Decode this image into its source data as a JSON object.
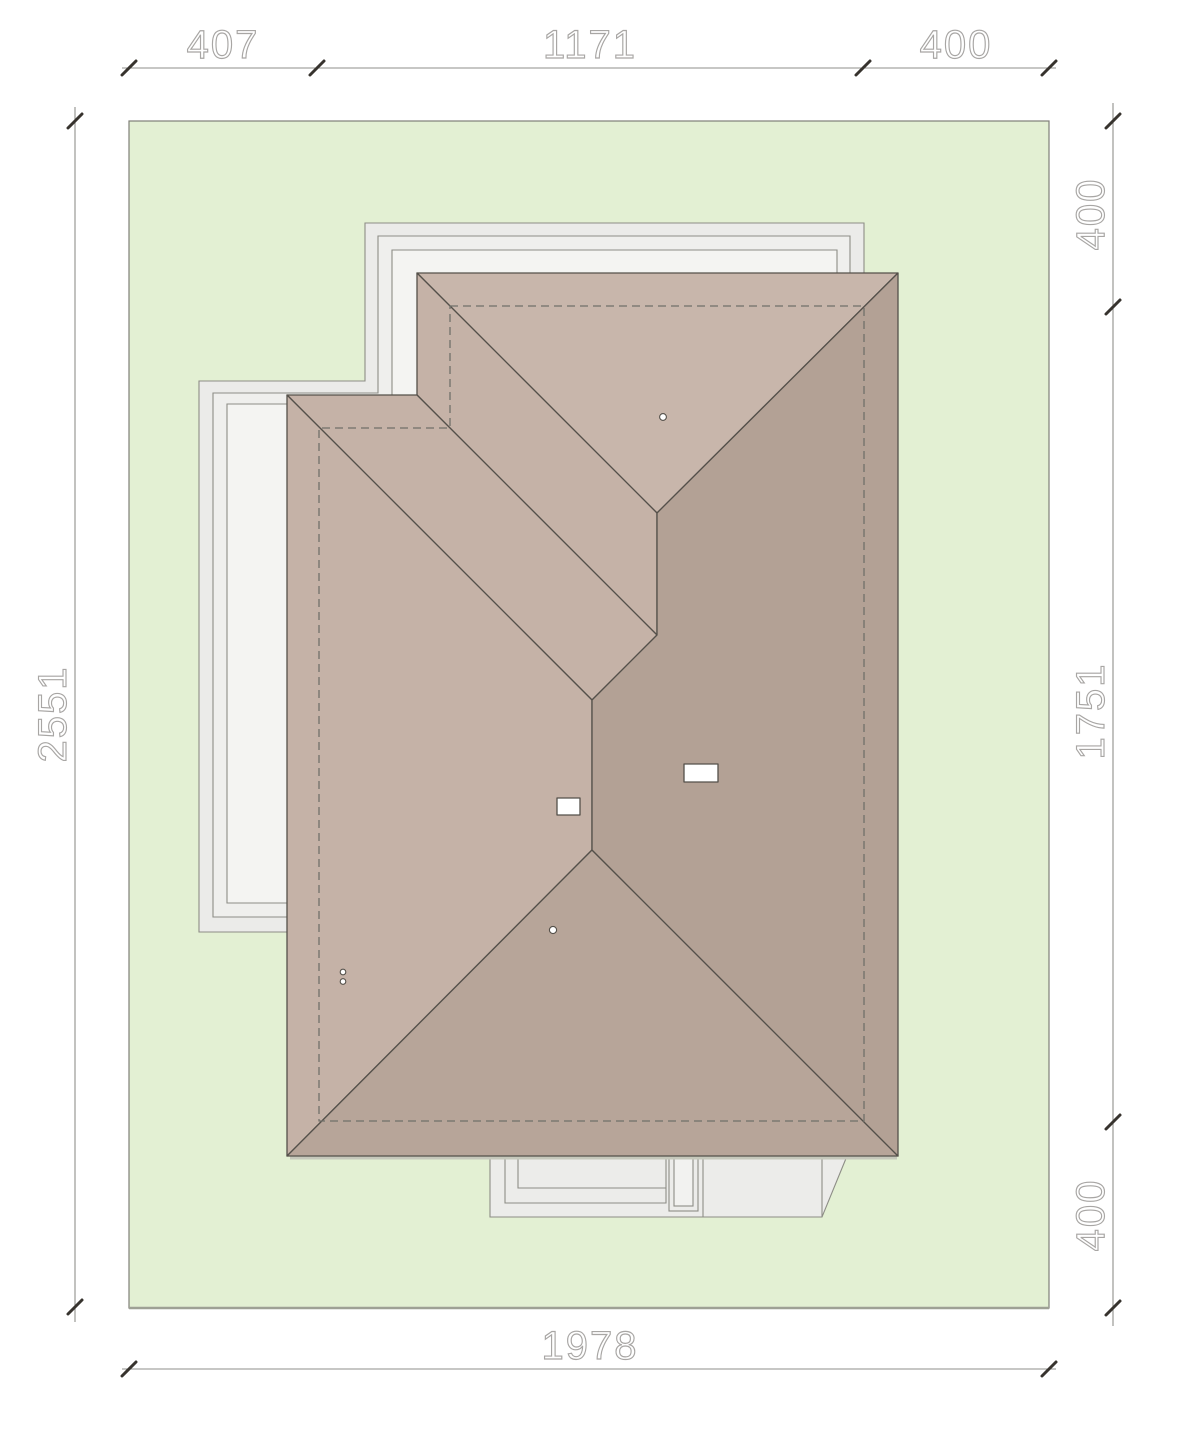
{
  "drawing": {
    "kind": "architectural roof / site plan (top view)",
    "plot_units": "cm"
  },
  "dimensions": {
    "top": {
      "segment1": "407",
      "segment2": "1171",
      "segment3": "400"
    },
    "right": {
      "segment1": "400",
      "segment2": "1751",
      "segment3": "400"
    },
    "left": {
      "total": "2551"
    },
    "bottom": {
      "total": "1978"
    }
  },
  "colors": {
    "plot_green": "#e3f0d3",
    "roof_north_slope": "#c8b6ab",
    "roof_west_slopes": "#c5b2a7",
    "roof_east_slope": "#b3a195",
    "roof_south_slope": "#b7a599",
    "roof_edge_line": "#54504a",
    "wall_dashed_line": "#70706a",
    "paving_fill": "#ededeb",
    "paving_stroke": "#8d8d86",
    "dimension_line": "#8f8f8b",
    "dimension_tick": "#37332e",
    "dimension_text": "#a8a6a4"
  }
}
